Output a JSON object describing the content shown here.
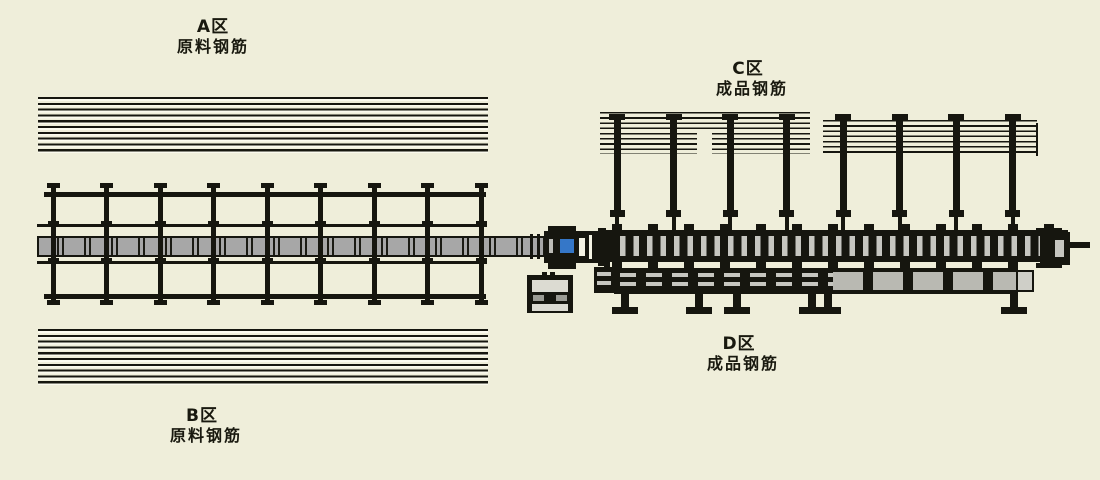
{
  "diagram_title": "Rebar processing line layout",
  "zones": {
    "a": {
      "title": "A区",
      "subtitle": "原料钢筋"
    },
    "b": {
      "title": "B区",
      "subtitle": "原料钢筋"
    },
    "c": {
      "title": "C区",
      "subtitle": "成品钢筋"
    },
    "d": {
      "title": "D区",
      "subtitle": "成品钢筋"
    }
  },
  "colors": {
    "background": "#efeeda",
    "structure": "#16160f",
    "conveyor_gray": "#a7a7a7",
    "slat_gray": "#c6c6c0",
    "panel_gray": "#dcdbd2",
    "accent_blue": "#3577c8"
  }
}
